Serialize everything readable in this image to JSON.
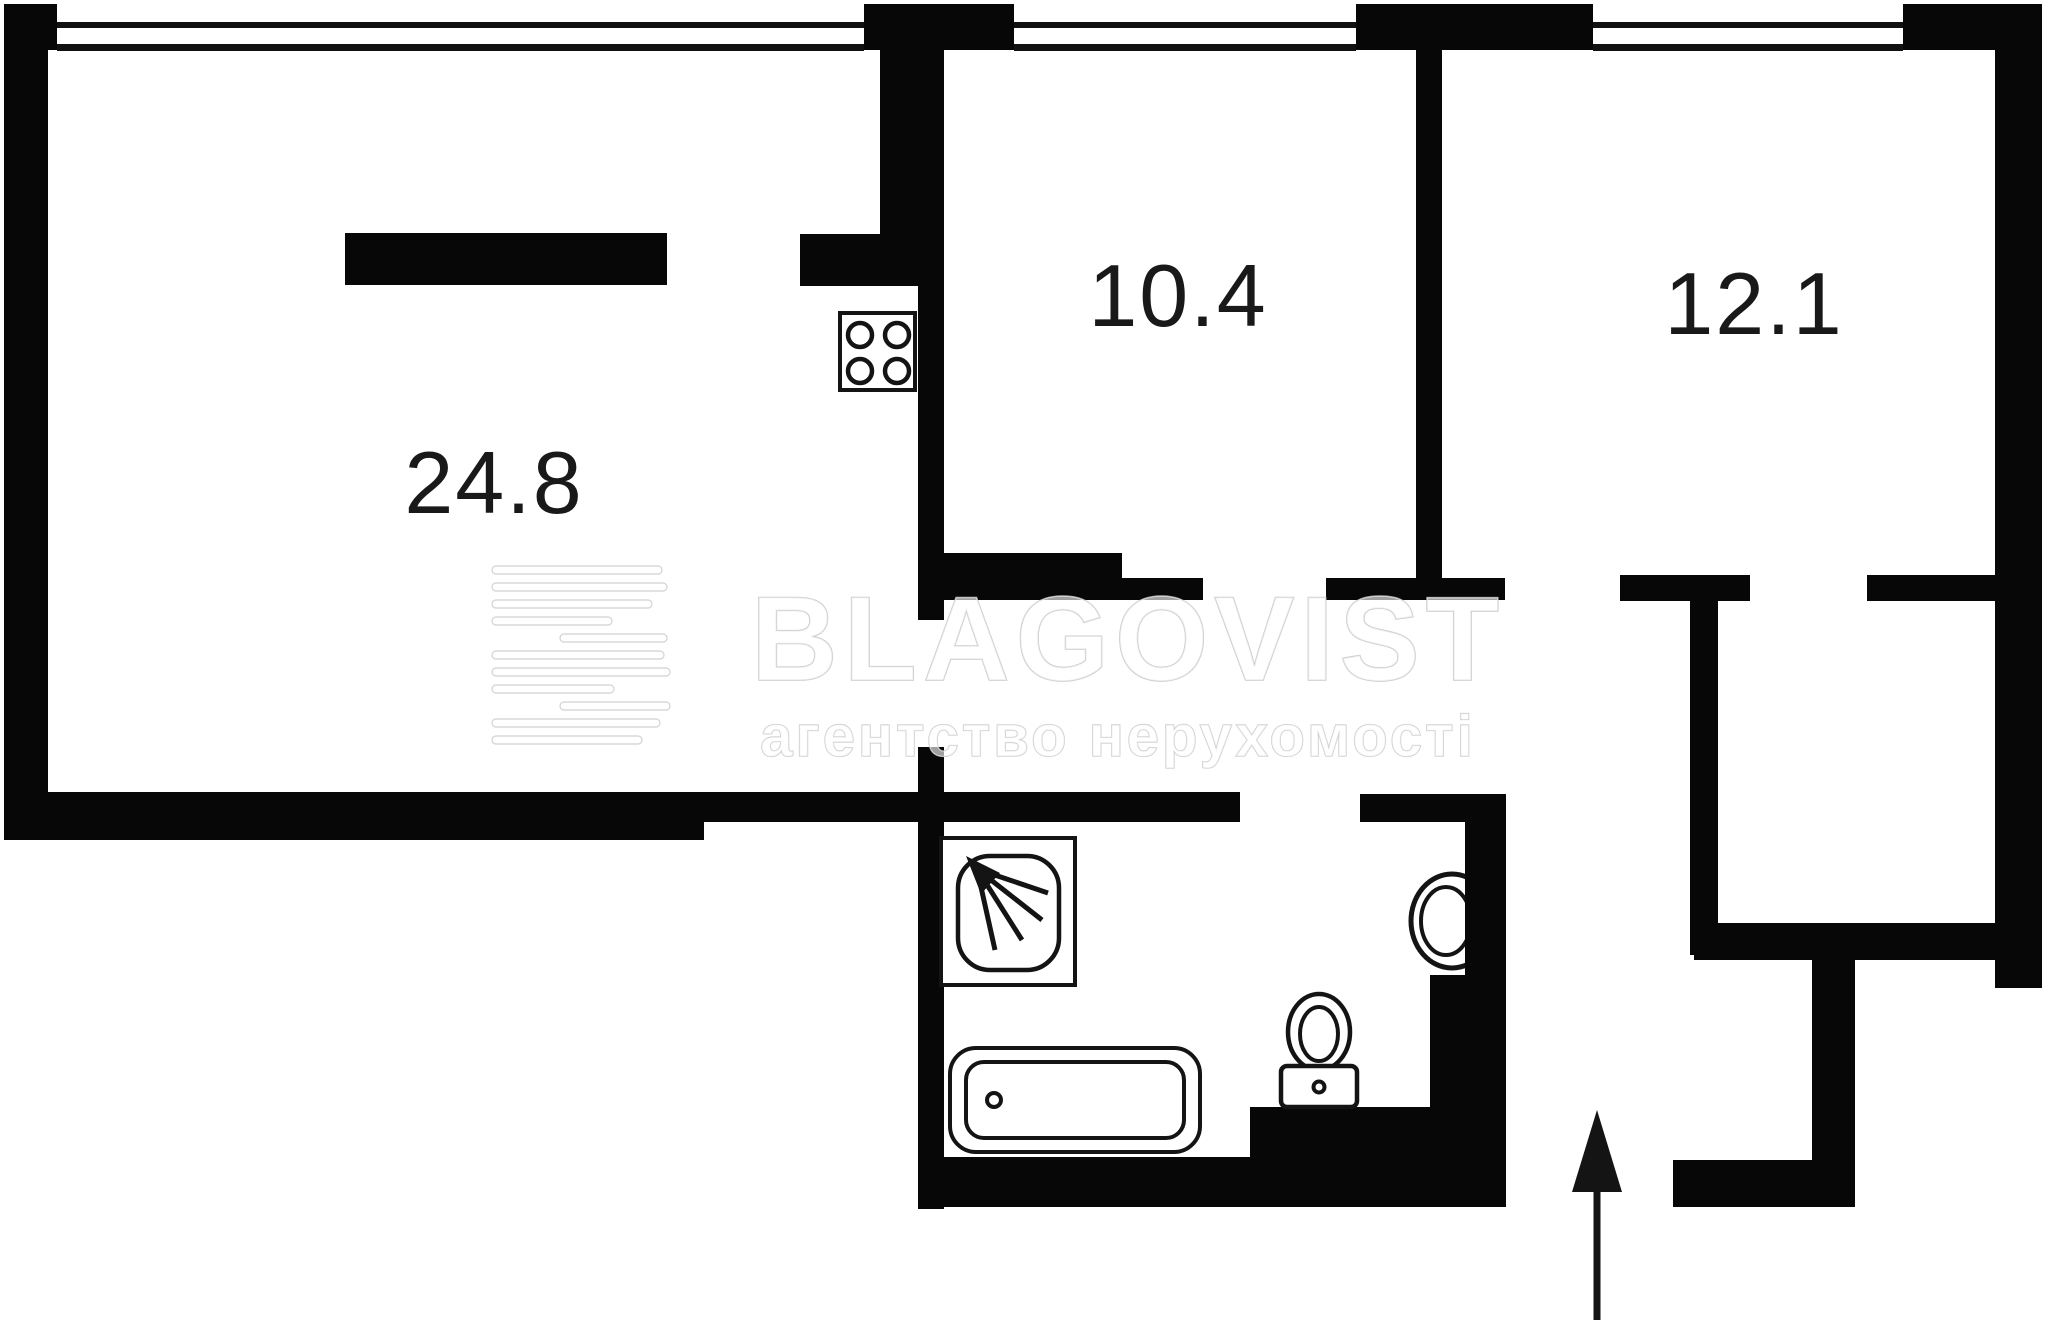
{
  "floor_plan": {
    "type": "apartment-floor-plan",
    "rooms": [
      {
        "id": "living-room",
        "area_label": "24.8"
      },
      {
        "id": "room-center",
        "area_label": "10.4"
      },
      {
        "id": "room-right",
        "area_label": "12.1"
      }
    ],
    "fixtures": [
      "stove-icon",
      "shower-icon",
      "bathtub-icon",
      "toilet-icon",
      "sink-icon",
      "entrance-arrow-icon"
    ],
    "watermark": {
      "brand": "BLAGOVIST",
      "tagline": "агентство нерухомості"
    },
    "colors": {
      "wall": "#070707",
      "background": "#ffffff",
      "watermark": "#dcdcdc",
      "label": "#191919"
    }
  }
}
